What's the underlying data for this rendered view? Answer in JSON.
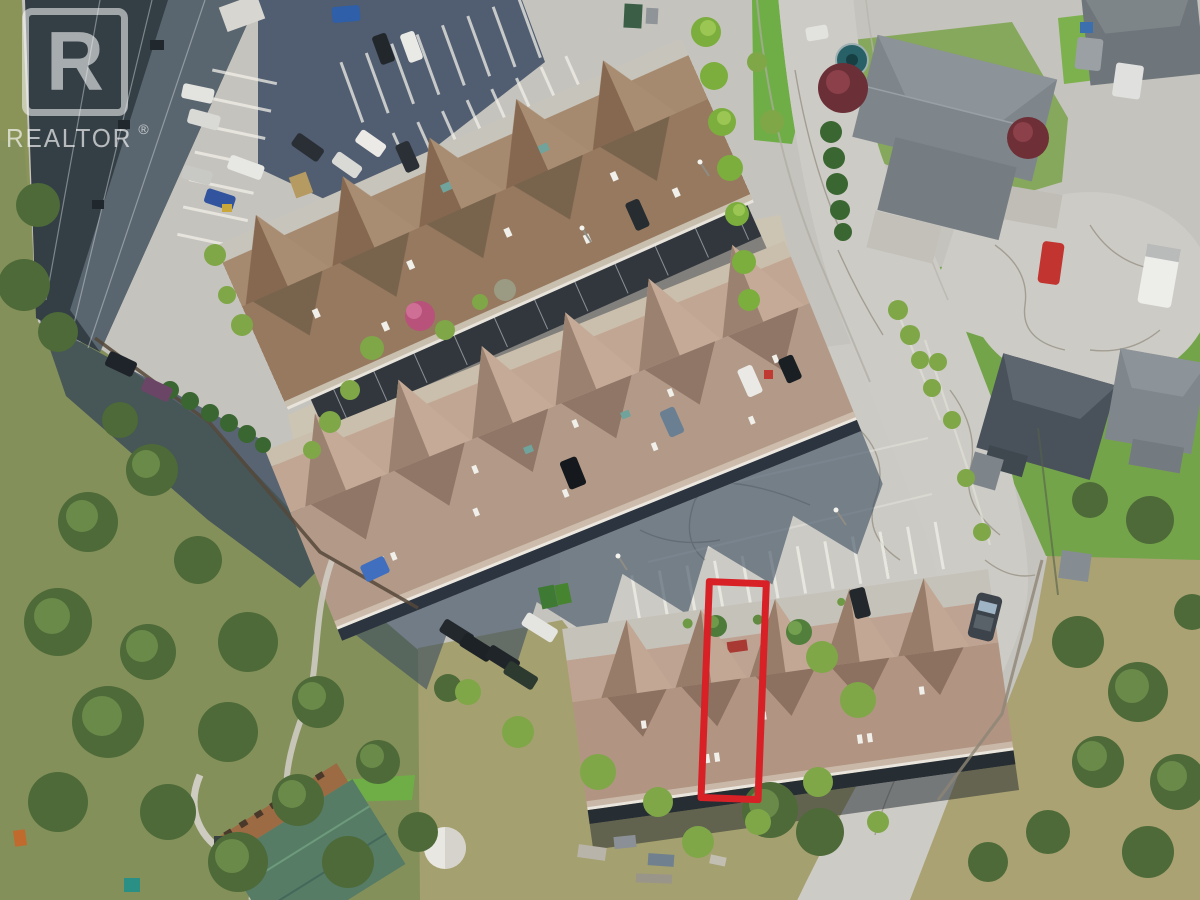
{
  "watermark": {
    "logo_letter": "R",
    "brand": "REALTOR",
    "registered_mark": "®",
    "color": "rgba(252,252,252,0.62)"
  },
  "highlight": {
    "color": "#d82127",
    "shape": "rectangle",
    "marks": "outlined townhouse unit with its parking stall"
  },
  "scene": {
    "setting": "aerial drone view of a hillside townhouse complex and residential street",
    "features": [
      "dark flat-roof apartment building (top left)",
      "three brown-shingle townhouse rows with gabled units",
      "parking lots with marked stalls and parked vehicles",
      "curving street ending in a cracked cul-de-sac (top right)",
      "detached gray-roof houses with green lawns",
      "treed slope and dry grass hillside (bottom left)",
      "green-roof house with wood deck and white dome tent (bottom)",
      "red outline highlighting one townhouse unit"
    ]
  }
}
